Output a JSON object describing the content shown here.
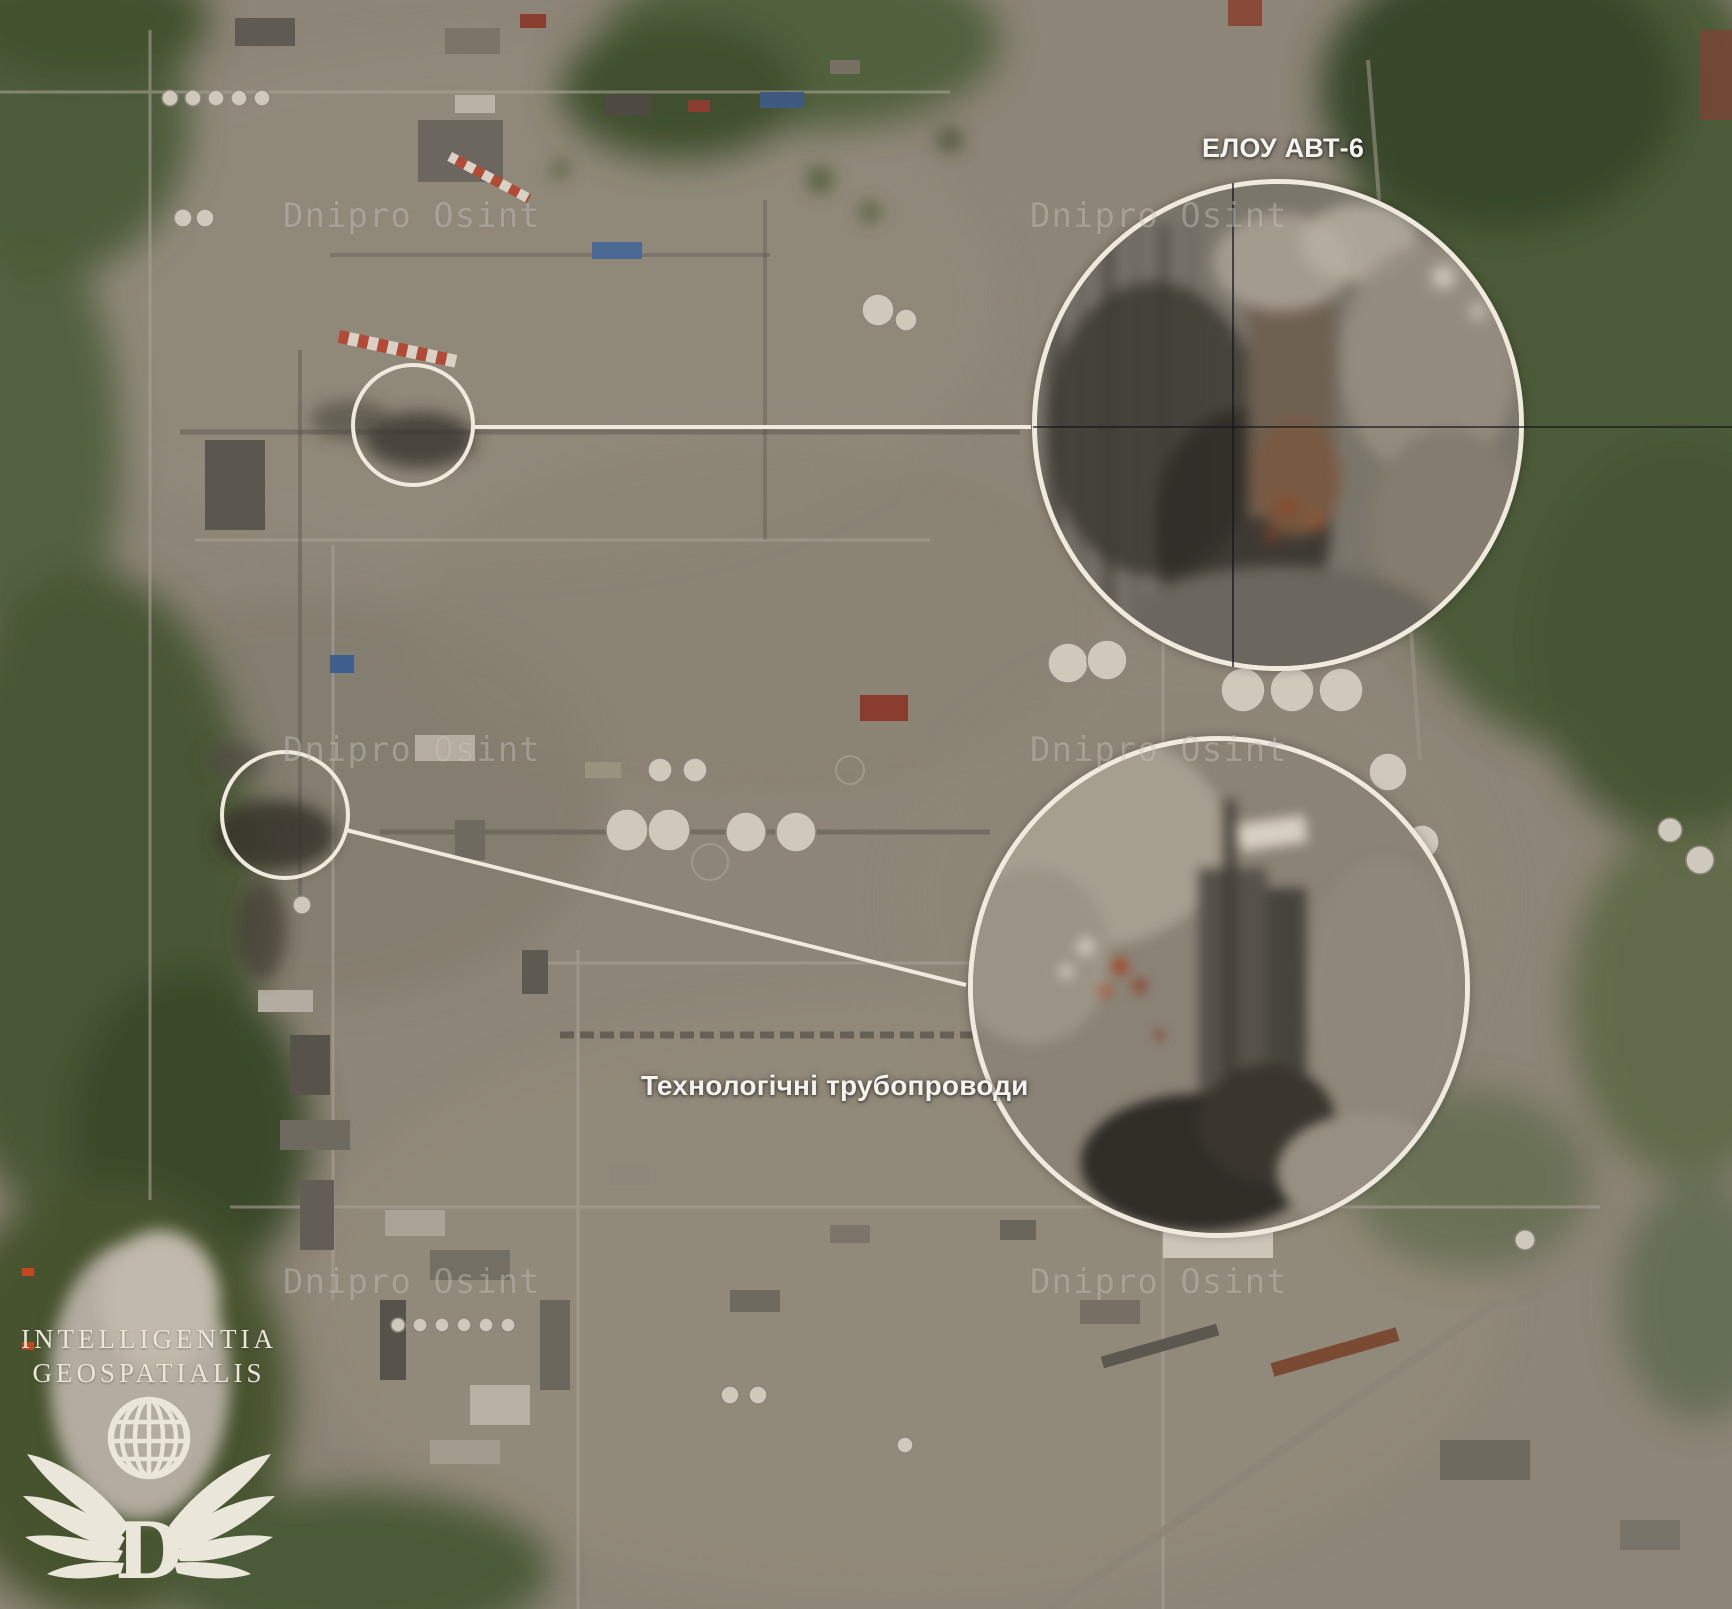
{
  "callouts": [
    {
      "id": "elou-avt-6",
      "label": "ЕЛОУ АВТ-6"
    },
    {
      "id": "process-pipelines",
      "label": "Технологічні трубопроводи"
    }
  ],
  "watermark": {
    "text": "Dnipro Osint",
    "count": 6
  },
  "logo": {
    "line1": "INTELLIGENTIA",
    "line2": "GEOSPATIALIS",
    "monogram": "D",
    "icon": "winged-globe-icon"
  },
  "colors": {
    "annotation_cream": "#efeadd",
    "label_white": "#f4f3ef",
    "watermark_gray": "#c9c6bf",
    "crosshair_black": "#17171c",
    "logo_cream": "#eae6da"
  }
}
